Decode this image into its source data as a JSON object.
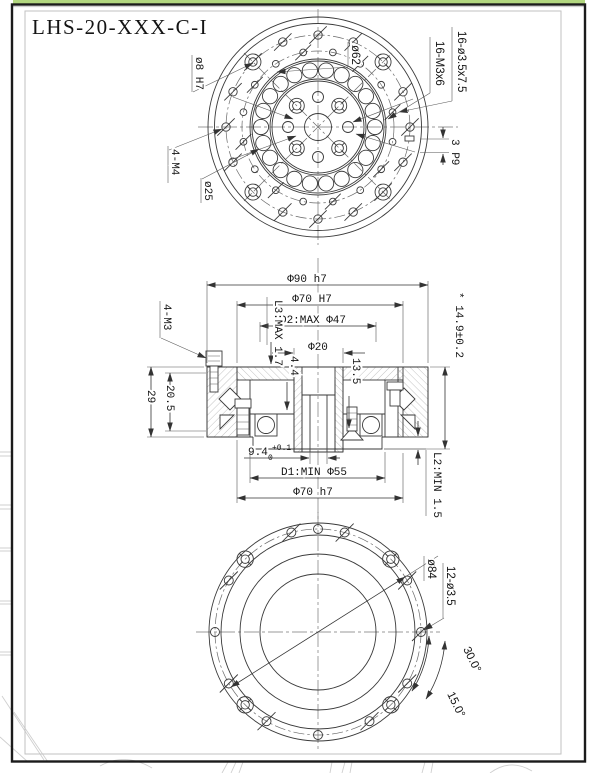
{
  "drawing": {
    "title": "LHS-20-XXX-C-I",
    "top_view": {
      "pin_hole": "ø8 H7",
      "tapped_m4": "4-M4",
      "dia_25": "ø25",
      "bolt_circle_62": "ø62",
      "cbore_holes": "16-ø3.5x7.5",
      "tapped_m3_ring": "16-M3x6",
      "key_width": "3 P9"
    },
    "section_view": {
      "dia_90": "Φ90 h7",
      "dia_70_top": "Φ70 H7",
      "d2_max": "D2:MAX Φ47",
      "dia_20": "Φ20",
      "l3_max": "L3:MAX 1.7",
      "tapped_m3": "4-M3",
      "overall_height": "* 14.9±0.2",
      "h_29": "29",
      "h_20_5": "20.5",
      "h_4_4": "4.4",
      "h_13_5": "13.5",
      "w_9_4": "9.4",
      "w_9_4_sup": "+0.1",
      "w_9_4_sub": "0",
      "d1_min": "D1:MIN Φ55",
      "dia_70_bottom": "Φ70 h7",
      "l2_min": "L2:MIN 1.5"
    },
    "bottom_view": {
      "bolt_circle_84": "ø84",
      "holes_3_5": "12-ø3.5",
      "angle_30": "30.0°",
      "angle_15": "15.0°"
    },
    "colors": {
      "accent": "#b2d77f"
    }
  }
}
